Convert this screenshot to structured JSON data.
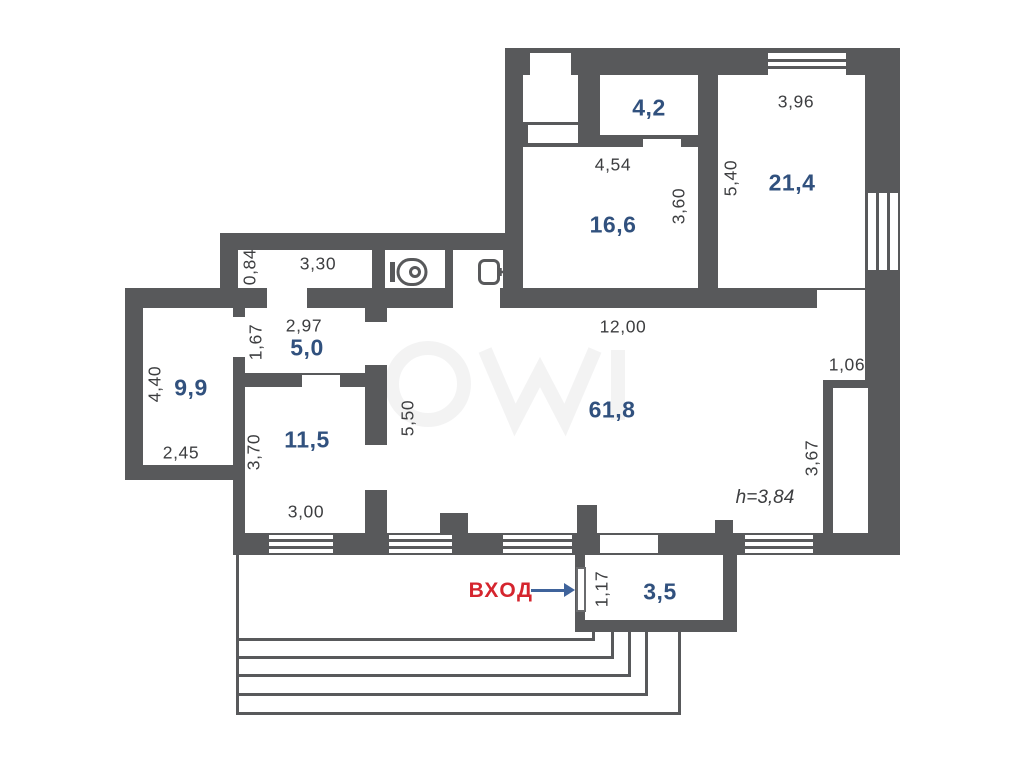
{
  "colors": {
    "wall": "#58595b",
    "area_text": "#31517e",
    "dim_text": "#3d3e40",
    "entrance_text": "#d5252e",
    "arrow": "#3f639b"
  },
  "entrance": {
    "label": "ВХОД"
  },
  "ceiling": {
    "label": "h=3,84"
  },
  "rooms": {
    "r42": {
      "area": "4,2"
    },
    "r166": {
      "area": "16,6",
      "top": "4,54",
      "side": "3,60"
    },
    "r214": {
      "area": "21,4",
      "top": "3,96",
      "side": "5,40"
    },
    "corridor": {
      "top": "3,30",
      "side": "0,84"
    },
    "r50": {
      "area": "5,0",
      "top": "2,97",
      "side": "1,67"
    },
    "r99": {
      "area": "9,9",
      "side": "4,40",
      "bottom": "2,45"
    },
    "r115": {
      "area": "11,5",
      "side": "3,70",
      "bottom": "3,00"
    },
    "r618": {
      "area": "61,8",
      "top": "12,00",
      "side": "5,50",
      "niche_top": "1,06",
      "niche_side": "3,67"
    },
    "r35": {
      "area": "3,5",
      "door": "1,17"
    }
  },
  "icons": {
    "toilet": "toilet-icon",
    "sink": "sink-icon"
  }
}
